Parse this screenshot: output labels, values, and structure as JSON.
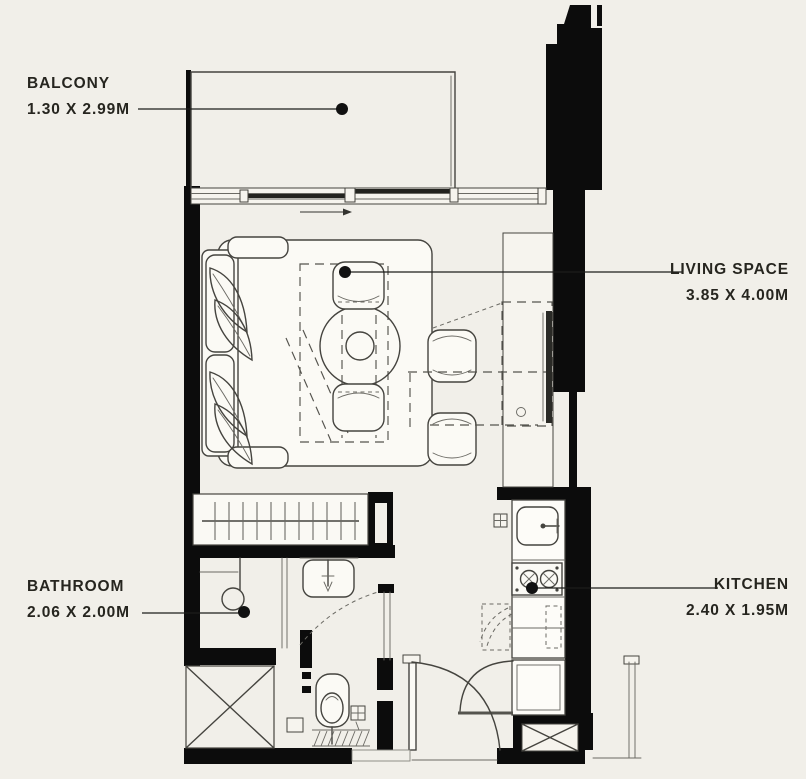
{
  "canvas": {
    "background": "#f1efe9",
    "wall_color": "#0c0c0c",
    "line_color": "#45443f",
    "label_color": "#26251f"
  },
  "labels": {
    "balcony": {
      "title": "BALCONY",
      "size": "1.30 X 2.99M"
    },
    "living": {
      "title": "LIVING SPACE",
      "size": "3.85 X 4.00M"
    },
    "bathroom": {
      "title": "BATHROOM",
      "size": "2.06 X 2.00M"
    },
    "kitchen": {
      "title": "KITCHEN",
      "size": "2.40 X 1.95M"
    }
  }
}
